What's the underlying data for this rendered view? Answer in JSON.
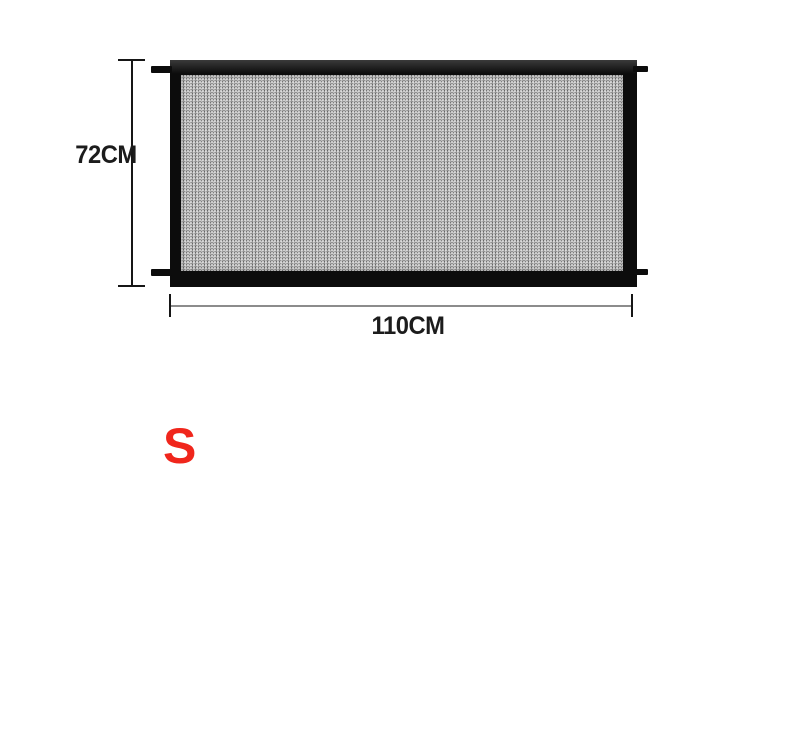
{
  "diagram": {
    "product": "mesh-gate-dimension-diagram",
    "height_label": "72CM",
    "width_label": "110CM",
    "size_label": "S",
    "colors": {
      "frame_black": "#0c0c0c",
      "mesh_gray": "#a6a6a6",
      "size_label_red": "#f0261c",
      "dimension_line_dark": "#161616",
      "dimension_line_gray": "#8c8c8c",
      "background": "#ffffff"
    }
  }
}
